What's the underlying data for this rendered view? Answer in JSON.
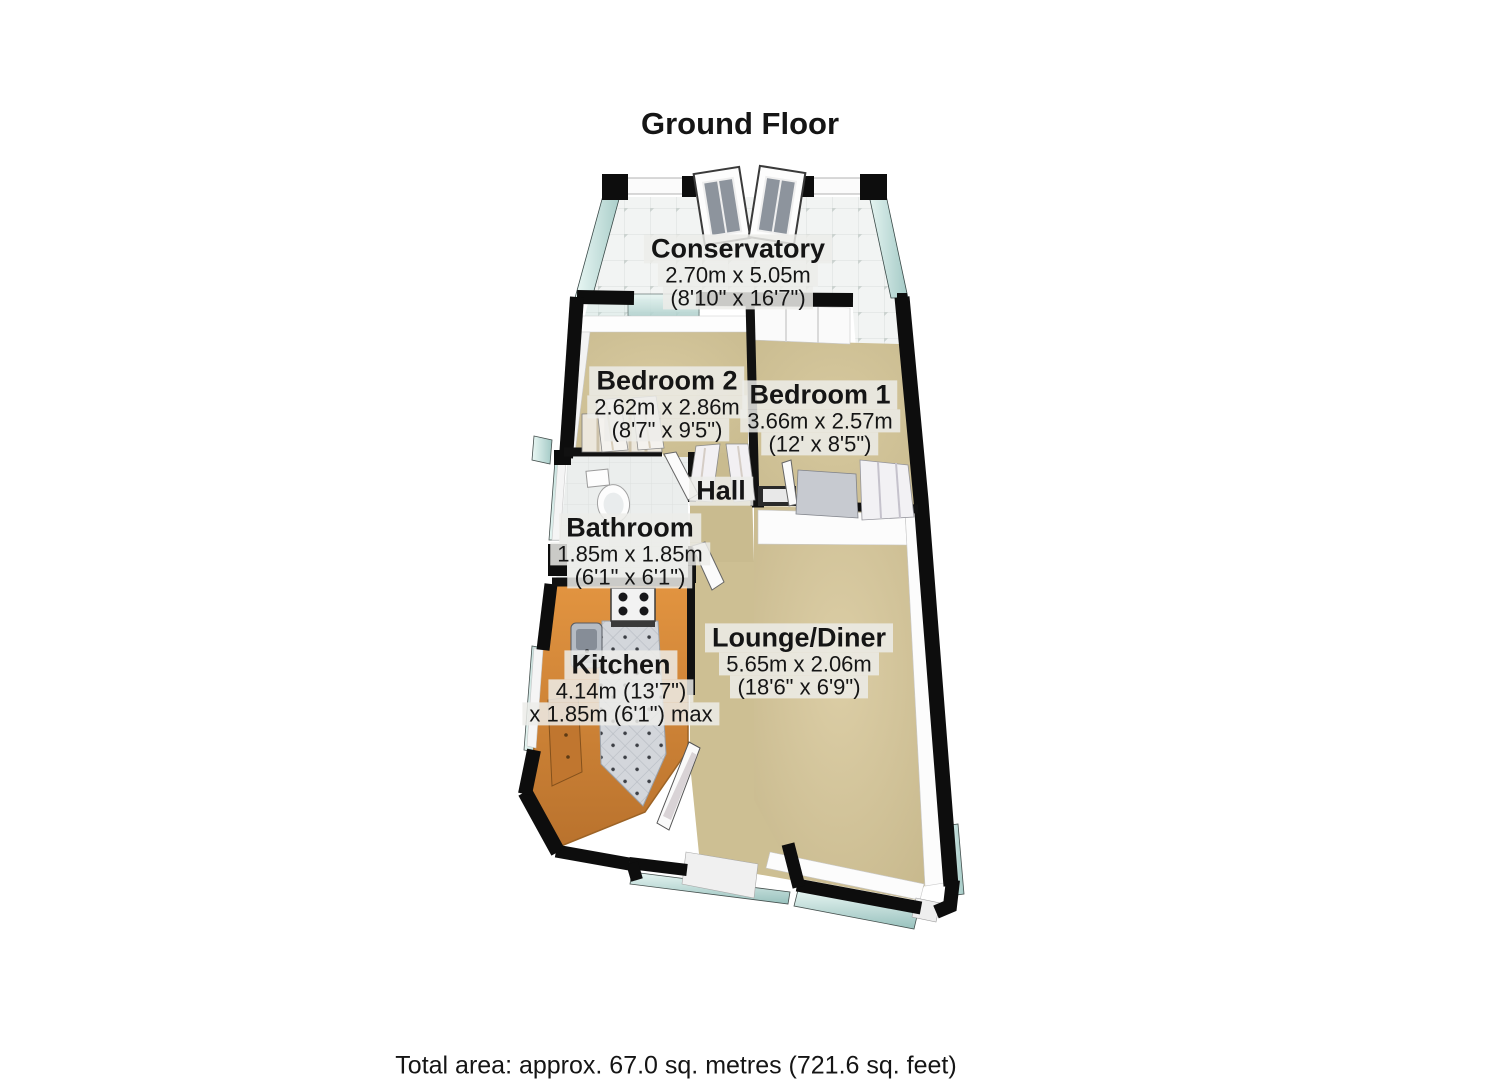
{
  "title": "Ground Floor",
  "footer": {
    "total_area": "Total area: approx. 67.0 sq. metres (721.6 sq. feet)"
  },
  "rooms": {
    "conservatory": {
      "name": "Conservatory",
      "metric": "2.70m x 5.05m",
      "imperial": "(8'10\" x 16'7\")"
    },
    "bedroom2": {
      "name": "Bedroom 2",
      "metric": "2.62m x 2.86m",
      "imperial": "(8'7\" x 9'5\")"
    },
    "bedroom1": {
      "name": "Bedroom 1",
      "metric": "3.66m x 2.57m",
      "imperial": "(12' x 8'5\")"
    },
    "hall": {
      "name": "Hall"
    },
    "bathroom": {
      "name": "Bathroom",
      "metric": "1.85m x 1.85m",
      "imperial": "(6'1\" x 6'1\")"
    },
    "kitchen": {
      "name": "Kitchen",
      "metric": "4.14m (13'7\")",
      "imperial": "x 1.85m (6'1\") max"
    },
    "lounge": {
      "name": "Lounge/Diner",
      "metric": "5.65m x 2.06m",
      "imperial": "(18'6\" x 6'9\")"
    }
  },
  "colors": {
    "wall": "#0d0d0d",
    "carpet": "#d2c49a",
    "hall_carpet": "#c9bb8f",
    "kitchen_floor": "#d8883a",
    "kitchen_tile": "#d3d6db",
    "bathroom_tile": "#ebeeed",
    "conservatory_tile": "#f2f4f3",
    "window_glass": "#bcdcd8",
    "inner_wall_face": "#fcfcfc",
    "label_background": "#ececea",
    "text": "#151515"
  }
}
